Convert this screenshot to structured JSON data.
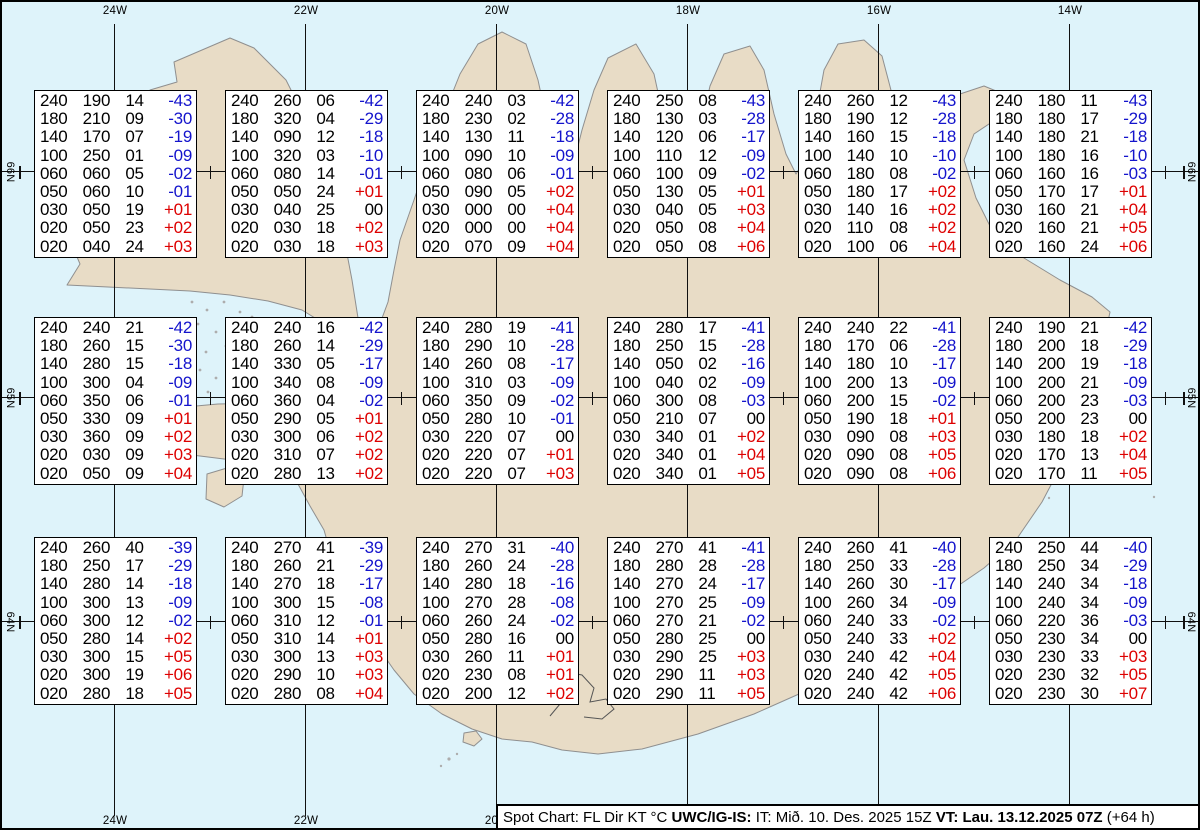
{
  "map": {
    "sea_color": "#def3fa",
    "land_color": "#e8dcc6",
    "coast_color": "#8f8f8f",
    "meridians": [
      {
        "label": "24W",
        "x": 113
      },
      {
        "label": "22W",
        "x": 304
      },
      {
        "label": "20W",
        "x": 495
      },
      {
        "label": "18W",
        "x": 686
      },
      {
        "label": "16W",
        "x": 877
      },
      {
        "label": "14W",
        "x": 1068
      }
    ],
    "parallels": [
      {
        "label": "66N",
        "y": 170
      },
      {
        "label": "65N",
        "y": 396
      },
      {
        "label": "64N",
        "y": 620
      }
    ]
  },
  "value_colors": {
    "negative": "#1414cc",
    "positive": "#dd0000",
    "zero": "#000000"
  },
  "spots": [
    {
      "lat": "66N",
      "lon": "24W",
      "cx": 113,
      "cy": 172,
      "rows": [
        [
          "240",
          "190",
          "14",
          "-43"
        ],
        [
          "180",
          "210",
          "09",
          "-30"
        ],
        [
          "140",
          "170",
          "07",
          "-19"
        ],
        [
          "100",
          "250",
          "01",
          "-09"
        ],
        [
          "060",
          "060",
          "05",
          "-02"
        ],
        [
          "050",
          "060",
          "10",
          "-01"
        ],
        [
          "030",
          "050",
          "19",
          "+01"
        ],
        [
          "020",
          "050",
          "23",
          "+02"
        ],
        [
          "020",
          "040",
          "24",
          "+03"
        ]
      ]
    },
    {
      "lat": "66N",
      "lon": "22W",
      "cx": 304,
      "cy": 172,
      "rows": [
        [
          "240",
          "260",
          "06",
          "-42"
        ],
        [
          "180",
          "320",
          "04",
          "-29"
        ],
        [
          "140",
          "090",
          "12",
          "-18"
        ],
        [
          "100",
          "320",
          "03",
          "-10"
        ],
        [
          "060",
          "080",
          "14",
          "-01"
        ],
        [
          "050",
          "050",
          "24",
          "+01"
        ],
        [
          "030",
          "040",
          "25",
          "00"
        ],
        [
          "020",
          "030",
          "18",
          "+02"
        ],
        [
          "020",
          "030",
          "18",
          "+03"
        ]
      ]
    },
    {
      "lat": "66N",
      "lon": "20W",
      "cx": 495,
      "cy": 172,
      "rows": [
        [
          "240",
          "240",
          "03",
          "-42"
        ],
        [
          "180",
          "230",
          "02",
          "-28"
        ],
        [
          "140",
          "130",
          "11",
          "-18"
        ],
        [
          "100",
          "090",
          "10",
          "-09"
        ],
        [
          "060",
          "080",
          "06",
          "-01"
        ],
        [
          "050",
          "090",
          "05",
          "+02"
        ],
        [
          "030",
          "000",
          "00",
          "+04"
        ],
        [
          "020",
          "000",
          "00",
          "+04"
        ],
        [
          "020",
          "070",
          "09",
          "+04"
        ]
      ]
    },
    {
      "lat": "66N",
      "lon": "18W",
      "cx": 686,
      "cy": 172,
      "rows": [
        [
          "240",
          "250",
          "08",
          "-43"
        ],
        [
          "180",
          "130",
          "03",
          "-28"
        ],
        [
          "140",
          "120",
          "06",
          "-17"
        ],
        [
          "100",
          "110",
          "12",
          "-09"
        ],
        [
          "060",
          "100",
          "09",
          "-02"
        ],
        [
          "050",
          "130",
          "05",
          "+01"
        ],
        [
          "030",
          "040",
          "05",
          "+03"
        ],
        [
          "020",
          "050",
          "08",
          "+04"
        ],
        [
          "020",
          "050",
          "08",
          "+06"
        ]
      ]
    },
    {
      "lat": "66N",
      "lon": "16W",
      "cx": 877,
      "cy": 172,
      "rows": [
        [
          "240",
          "260",
          "12",
          "-43"
        ],
        [
          "180",
          "190",
          "12",
          "-28"
        ],
        [
          "140",
          "160",
          "15",
          "-18"
        ],
        [
          "100",
          "140",
          "10",
          "-10"
        ],
        [
          "060",
          "180",
          "08",
          "-02"
        ],
        [
          "050",
          "180",
          "17",
          "+02"
        ],
        [
          "030",
          "140",
          "16",
          "+02"
        ],
        [
          "020",
          "110",
          "08",
          "+02"
        ],
        [
          "020",
          "100",
          "06",
          "+04"
        ]
      ]
    },
    {
      "lat": "66N",
      "lon": "14W",
      "cx": 1068,
      "cy": 172,
      "rows": [
        [
          "240",
          "180",
          "11",
          "-43"
        ],
        [
          "180",
          "180",
          "17",
          "-29"
        ],
        [
          "140",
          "180",
          "21",
          "-18"
        ],
        [
          "100",
          "180",
          "16",
          "-10"
        ],
        [
          "060",
          "160",
          "16",
          "-03"
        ],
        [
          "050",
          "170",
          "17",
          "+01"
        ],
        [
          "030",
          "160",
          "21",
          "+04"
        ],
        [
          "020",
          "160",
          "21",
          "+05"
        ],
        [
          "020",
          "160",
          "24",
          "+06"
        ]
      ]
    },
    {
      "lat": "65N",
      "lon": "24W",
      "cx": 113,
      "cy": 399,
      "rows": [
        [
          "240",
          "240",
          "21",
          "-42"
        ],
        [
          "180",
          "260",
          "15",
          "-30"
        ],
        [
          "140",
          "280",
          "15",
          "-18"
        ],
        [
          "100",
          "300",
          "04",
          "-09"
        ],
        [
          "060",
          "350",
          "06",
          "-01"
        ],
        [
          "050",
          "330",
          "09",
          "+01"
        ],
        [
          "030",
          "360",
          "09",
          "+02"
        ],
        [
          "020",
          "030",
          "09",
          "+03"
        ],
        [
          "020",
          "050",
          "09",
          "+04"
        ]
      ]
    },
    {
      "lat": "65N",
      "lon": "22W",
      "cx": 304,
      "cy": 399,
      "rows": [
        [
          "240",
          "240",
          "16",
          "-42"
        ],
        [
          "180",
          "260",
          "14",
          "-29"
        ],
        [
          "140",
          "330",
          "05",
          "-17"
        ],
        [
          "100",
          "340",
          "08",
          "-09"
        ],
        [
          "060",
          "360",
          "04",
          "-02"
        ],
        [
          "050",
          "290",
          "05",
          "+01"
        ],
        [
          "030",
          "300",
          "06",
          "+02"
        ],
        [
          "020",
          "310",
          "07",
          "+02"
        ],
        [
          "020",
          "280",
          "13",
          "+02"
        ]
      ]
    },
    {
      "lat": "65N",
      "lon": "20W",
      "cx": 495,
      "cy": 399,
      "rows": [
        [
          "240",
          "280",
          "19",
          "-41"
        ],
        [
          "180",
          "290",
          "10",
          "-28"
        ],
        [
          "140",
          "260",
          "08",
          "-17"
        ],
        [
          "100",
          "310",
          "03",
          "-09"
        ],
        [
          "060",
          "350",
          "09",
          "-02"
        ],
        [
          "050",
          "280",
          "10",
          "-01"
        ],
        [
          "030",
          "220",
          "07",
          "00"
        ],
        [
          "020",
          "220",
          "07",
          "+01"
        ],
        [
          "020",
          "220",
          "07",
          "+03"
        ]
      ]
    },
    {
      "lat": "65N",
      "lon": "18W",
      "cx": 686,
      "cy": 399,
      "rows": [
        [
          "240",
          "280",
          "17",
          "-41"
        ],
        [
          "180",
          "250",
          "15",
          "-28"
        ],
        [
          "140",
          "050",
          "02",
          "-16"
        ],
        [
          "100",
          "040",
          "02",
          "-09"
        ],
        [
          "060",
          "300",
          "08",
          "-03"
        ],
        [
          "050",
          "210",
          "07",
          "00"
        ],
        [
          "030",
          "340",
          "01",
          "+02"
        ],
        [
          "020",
          "340",
          "01",
          "+04"
        ],
        [
          "020",
          "340",
          "01",
          "+05"
        ]
      ]
    },
    {
      "lat": "65N",
      "lon": "16W",
      "cx": 877,
      "cy": 399,
      "rows": [
        [
          "240",
          "240",
          "22",
          "-41"
        ],
        [
          "180",
          "170",
          "06",
          "-28"
        ],
        [
          "140",
          "180",
          "10",
          "-17"
        ],
        [
          "100",
          "200",
          "13",
          "-09"
        ],
        [
          "060",
          "200",
          "15",
          "-02"
        ],
        [
          "050",
          "190",
          "18",
          "+01"
        ],
        [
          "030",
          "090",
          "08",
          "+03"
        ],
        [
          "020",
          "090",
          "08",
          "+05"
        ],
        [
          "020",
          "090",
          "08",
          "+06"
        ]
      ]
    },
    {
      "lat": "65N",
      "lon": "14W",
      "cx": 1068,
      "cy": 399,
      "rows": [
        [
          "240",
          "190",
          "21",
          "-42"
        ],
        [
          "180",
          "200",
          "18",
          "-29"
        ],
        [
          "140",
          "200",
          "19",
          "-18"
        ],
        [
          "100",
          "200",
          "21",
          "-09"
        ],
        [
          "060",
          "200",
          "23",
          "-03"
        ],
        [
          "050",
          "200",
          "23",
          "00"
        ],
        [
          "030",
          "180",
          "18",
          "+02"
        ],
        [
          "020",
          "170",
          "13",
          "+04"
        ],
        [
          "020",
          "170",
          "11",
          "+05"
        ]
      ]
    },
    {
      "lat": "64N",
      "lon": "24W",
      "cx": 113,
      "cy": 619,
      "rows": [
        [
          "240",
          "260",
          "40",
          "-39"
        ],
        [
          "180",
          "250",
          "17",
          "-29"
        ],
        [
          "140",
          "280",
          "14",
          "-18"
        ],
        [
          "100",
          "300",
          "13",
          "-09"
        ],
        [
          "060",
          "300",
          "12",
          "-02"
        ],
        [
          "050",
          "280",
          "14",
          "+02"
        ],
        [
          "030",
          "300",
          "15",
          "+05"
        ],
        [
          "020",
          "300",
          "19",
          "+06"
        ],
        [
          "020",
          "280",
          "18",
          "+05"
        ]
      ]
    },
    {
      "lat": "64N",
      "lon": "22W",
      "cx": 304,
      "cy": 619,
      "rows": [
        [
          "240",
          "270",
          "41",
          "-39"
        ],
        [
          "180",
          "260",
          "21",
          "-29"
        ],
        [
          "140",
          "270",
          "18",
          "-17"
        ],
        [
          "100",
          "300",
          "15",
          "-08"
        ],
        [
          "060",
          "310",
          "12",
          "-01"
        ],
        [
          "050",
          "310",
          "14",
          "+01"
        ],
        [
          "030",
          "300",
          "13",
          "+03"
        ],
        [
          "020",
          "290",
          "10",
          "+03"
        ],
        [
          "020",
          "280",
          "08",
          "+04"
        ]
      ]
    },
    {
      "lat": "64N",
      "lon": "20W",
      "cx": 495,
      "cy": 619,
      "rows": [
        [
          "240",
          "270",
          "31",
          "-40"
        ],
        [
          "180",
          "260",
          "24",
          "-28"
        ],
        [
          "140",
          "280",
          "18",
          "-16"
        ],
        [
          "100",
          "270",
          "28",
          "-08"
        ],
        [
          "060",
          "260",
          "24",
          "-02"
        ],
        [
          "050",
          "280",
          "16",
          "00"
        ],
        [
          "030",
          "260",
          "11",
          "+01"
        ],
        [
          "020",
          "230",
          "08",
          "+01"
        ],
        [
          "020",
          "200",
          "12",
          "+02"
        ]
      ]
    },
    {
      "lat": "64N",
      "lon": "18W",
      "cx": 686,
      "cy": 619,
      "rows": [
        [
          "240",
          "270",
          "41",
          "-41"
        ],
        [
          "180",
          "280",
          "28",
          "-28"
        ],
        [
          "140",
          "270",
          "24",
          "-17"
        ],
        [
          "100",
          "270",
          "25",
          "-09"
        ],
        [
          "060",
          "270",
          "21",
          "-02"
        ],
        [
          "050",
          "280",
          "25",
          "00"
        ],
        [
          "030",
          "290",
          "25",
          "+03"
        ],
        [
          "020",
          "290",
          "11",
          "+03"
        ],
        [
          "020",
          "290",
          "11",
          "+05"
        ]
      ]
    },
    {
      "lat": "64N",
      "lon": "16W",
      "cx": 877,
      "cy": 619,
      "rows": [
        [
          "240",
          "260",
          "41",
          "-40"
        ],
        [
          "180",
          "250",
          "33",
          "-28"
        ],
        [
          "140",
          "260",
          "30",
          "-17"
        ],
        [
          "100",
          "260",
          "34",
          "-09"
        ],
        [
          "060",
          "240",
          "33",
          "-02"
        ],
        [
          "050",
          "240",
          "33",
          "+02"
        ],
        [
          "030",
          "240",
          "42",
          "+04"
        ],
        [
          "020",
          "240",
          "42",
          "+05"
        ],
        [
          "020",
          "240",
          "42",
          "+06"
        ]
      ]
    },
    {
      "lat": "64N",
      "lon": "14W",
      "cx": 1068,
      "cy": 619,
      "rows": [
        [
          "240",
          "250",
          "44",
          "-40"
        ],
        [
          "180",
          "250",
          "34",
          "-29"
        ],
        [
          "140",
          "240",
          "34",
          "-18"
        ],
        [
          "100",
          "240",
          "34",
          "-09"
        ],
        [
          "060",
          "220",
          "36",
          "-03"
        ],
        [
          "050",
          "230",
          "34",
          "00"
        ],
        [
          "030",
          "230",
          "33",
          "+03"
        ],
        [
          "020",
          "230",
          "32",
          "+05"
        ],
        [
          "020",
          "230",
          "30",
          "+07"
        ]
      ]
    }
  ],
  "footer": {
    "segments": [
      {
        "text": "Spot Chart: FL Dir KT °C ",
        "bold": false
      },
      {
        "text": "UWC/IG-IS:",
        "bold": true
      },
      {
        "text": " IT: Mið. 10. Des. 2025 15Z ",
        "bold": false
      },
      {
        "text": "VT: Lau. 13.12.2025 07Z",
        "bold": true
      },
      {
        "text": " (+64 h)",
        "bold": false
      }
    ]
  }
}
